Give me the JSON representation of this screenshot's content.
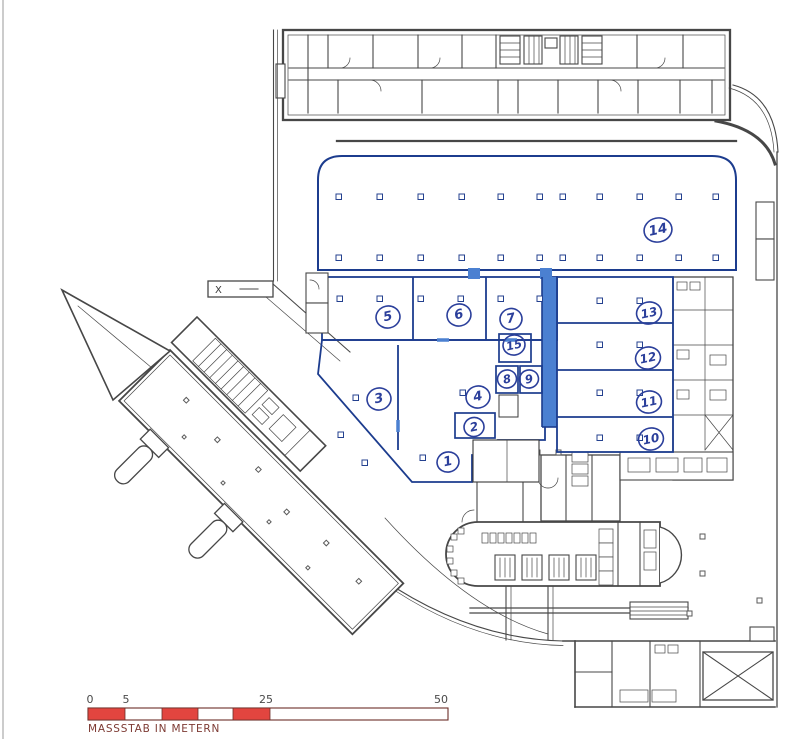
{
  "document": {
    "kind": "scanned architectural floor plan with highlighted rental areas"
  },
  "rooms": [
    {
      "label": "1"
    },
    {
      "label": "2"
    },
    {
      "label": "3"
    },
    {
      "label": "4"
    },
    {
      "label": "5"
    },
    {
      "label": "6"
    },
    {
      "label": "7"
    },
    {
      "label": "8"
    },
    {
      "label": "9"
    },
    {
      "label": "10"
    },
    {
      "label": "11"
    },
    {
      "label": "12"
    },
    {
      "label": "13"
    },
    {
      "label": "14"
    },
    {
      "label": "15"
    }
  ],
  "markers": {
    "section": "X"
  },
  "scalebar": {
    "caption": "MASSSTAB IN METERN",
    "ticks": [
      "0",
      "5",
      "25",
      "50"
    ],
    "unit_per_segment": 5,
    "total": 50
  },
  "colors": {
    "highlight": "#4b80d1",
    "highlight_wall": "#1c3c8e",
    "annotation": "#2b3f9b",
    "linework": "#474747",
    "scale_red": "#e2453f"
  }
}
